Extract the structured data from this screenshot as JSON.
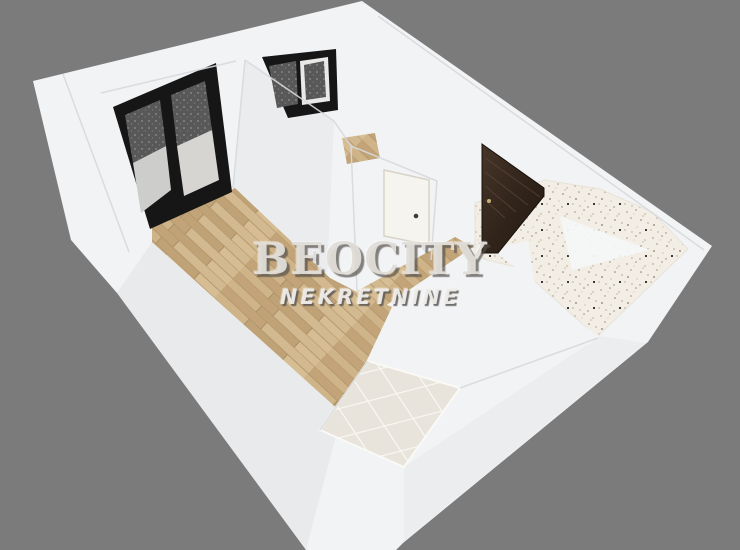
{
  "watermark": {
    "brand": "BEOCITY",
    "tagline": "NEKRETNINE"
  },
  "scene": {
    "background_color": "#7b7b7b",
    "wall_color": "#f2f3f5",
    "wood_floor_base": "#c9ad83",
    "tile_floor_base": "#e8e4db",
    "terrazzo_floor_base": "#f2eee5",
    "window_frame_color": "#161616",
    "entrance_door_color": "#3a2c21",
    "interior_door_color": "#f6f4ee"
  }
}
